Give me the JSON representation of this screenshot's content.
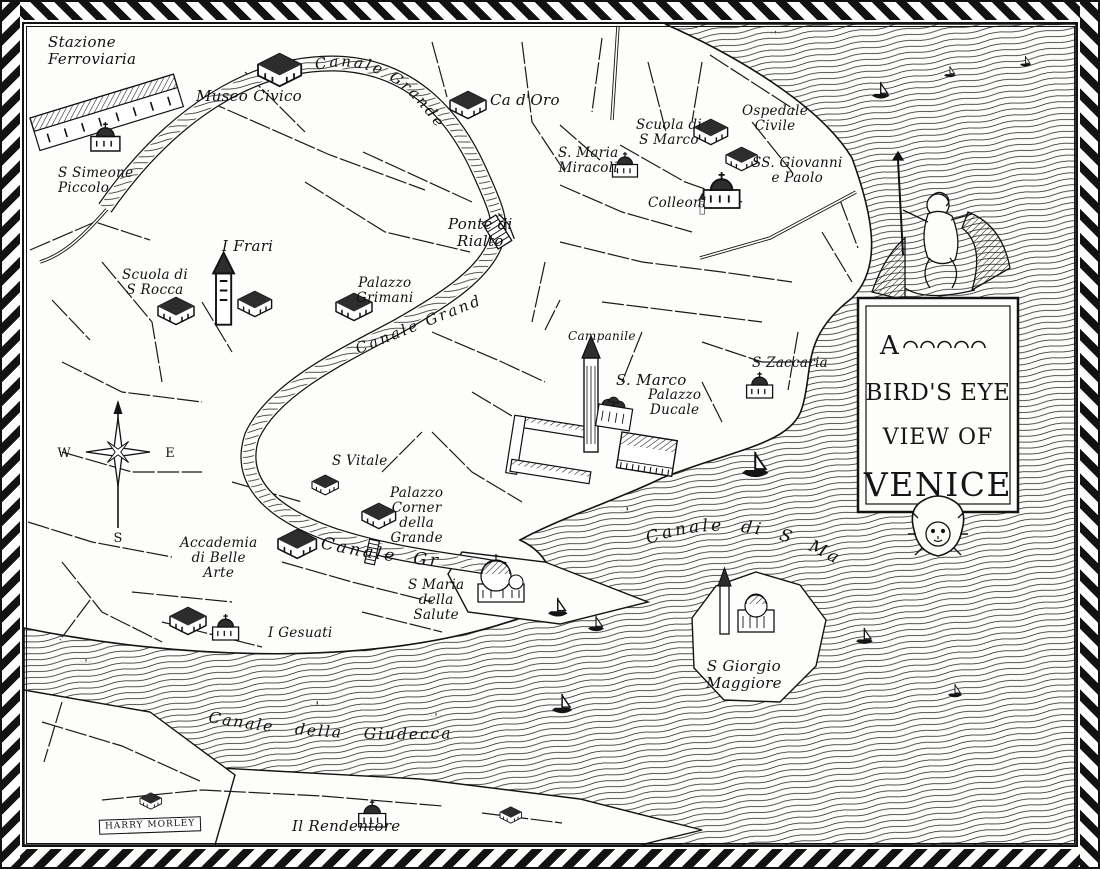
{
  "colors": {
    "ink": "#141414",
    "paper": "#fdfdfb"
  },
  "cartouche": {
    "line1": "A",
    "line2": "BIRD'S EYE",
    "line3": "VIEW OF",
    "line4": "VENICE"
  },
  "compass": {
    "west": "W",
    "east": "E",
    "south": "S"
  },
  "signature": "HARRY MORLEY",
  "canal_labels": {
    "grande_upper": "Canale Grande",
    "grande_middle": "Canale Grande",
    "grande_lower": "Canale Grande",
    "san_marco": "Canale di S Marco",
    "giudecca": "Canale della Giudecca"
  },
  "place_labels": {
    "stazione": "Stazione\nFerroviaria",
    "museo_civico": "Museo Civico",
    "ca_doro": "Ca d'Oro",
    "s_maria_miracoli": "S. Maria\nMiracoli",
    "scuola_s_marco": "Scuola di\nS Marco",
    "ospedale_civile": "Ospedale\nCivile",
    "ss_giovanni_e_paolo": "SS. Giovanni\ne Paolo",
    "colleoni": "Colleoni",
    "s_simeone_piccolo": "S Simeone\nPiccolo",
    "ponte_di_rialto": "Ponte di\nRialto",
    "i_frari": "I Frari",
    "scuola_s_rocca": "Scuola di\nS Rocca",
    "palazzo_grimani": "Palazzo\nGrimani",
    "campanile": "Campanile",
    "s_marco": "S. Marco",
    "palazzo_ducale": "Palazzo\nDucale",
    "s_zaccaria": "S Zaccaria",
    "s_vitale": "S Vitale",
    "palazzo_corner": "Palazzo\nCorner\ndella\nGrande",
    "accademia": "Accademia\ndi Belle\nArte",
    "s_maria_salute": "S Maria\ndella\nSalute",
    "i_gesuati": "I Gesuati",
    "s_giorgio_maggiore": "S Giorgio\nMaggiore",
    "il_rendentore": "Il Rendentore"
  }
}
